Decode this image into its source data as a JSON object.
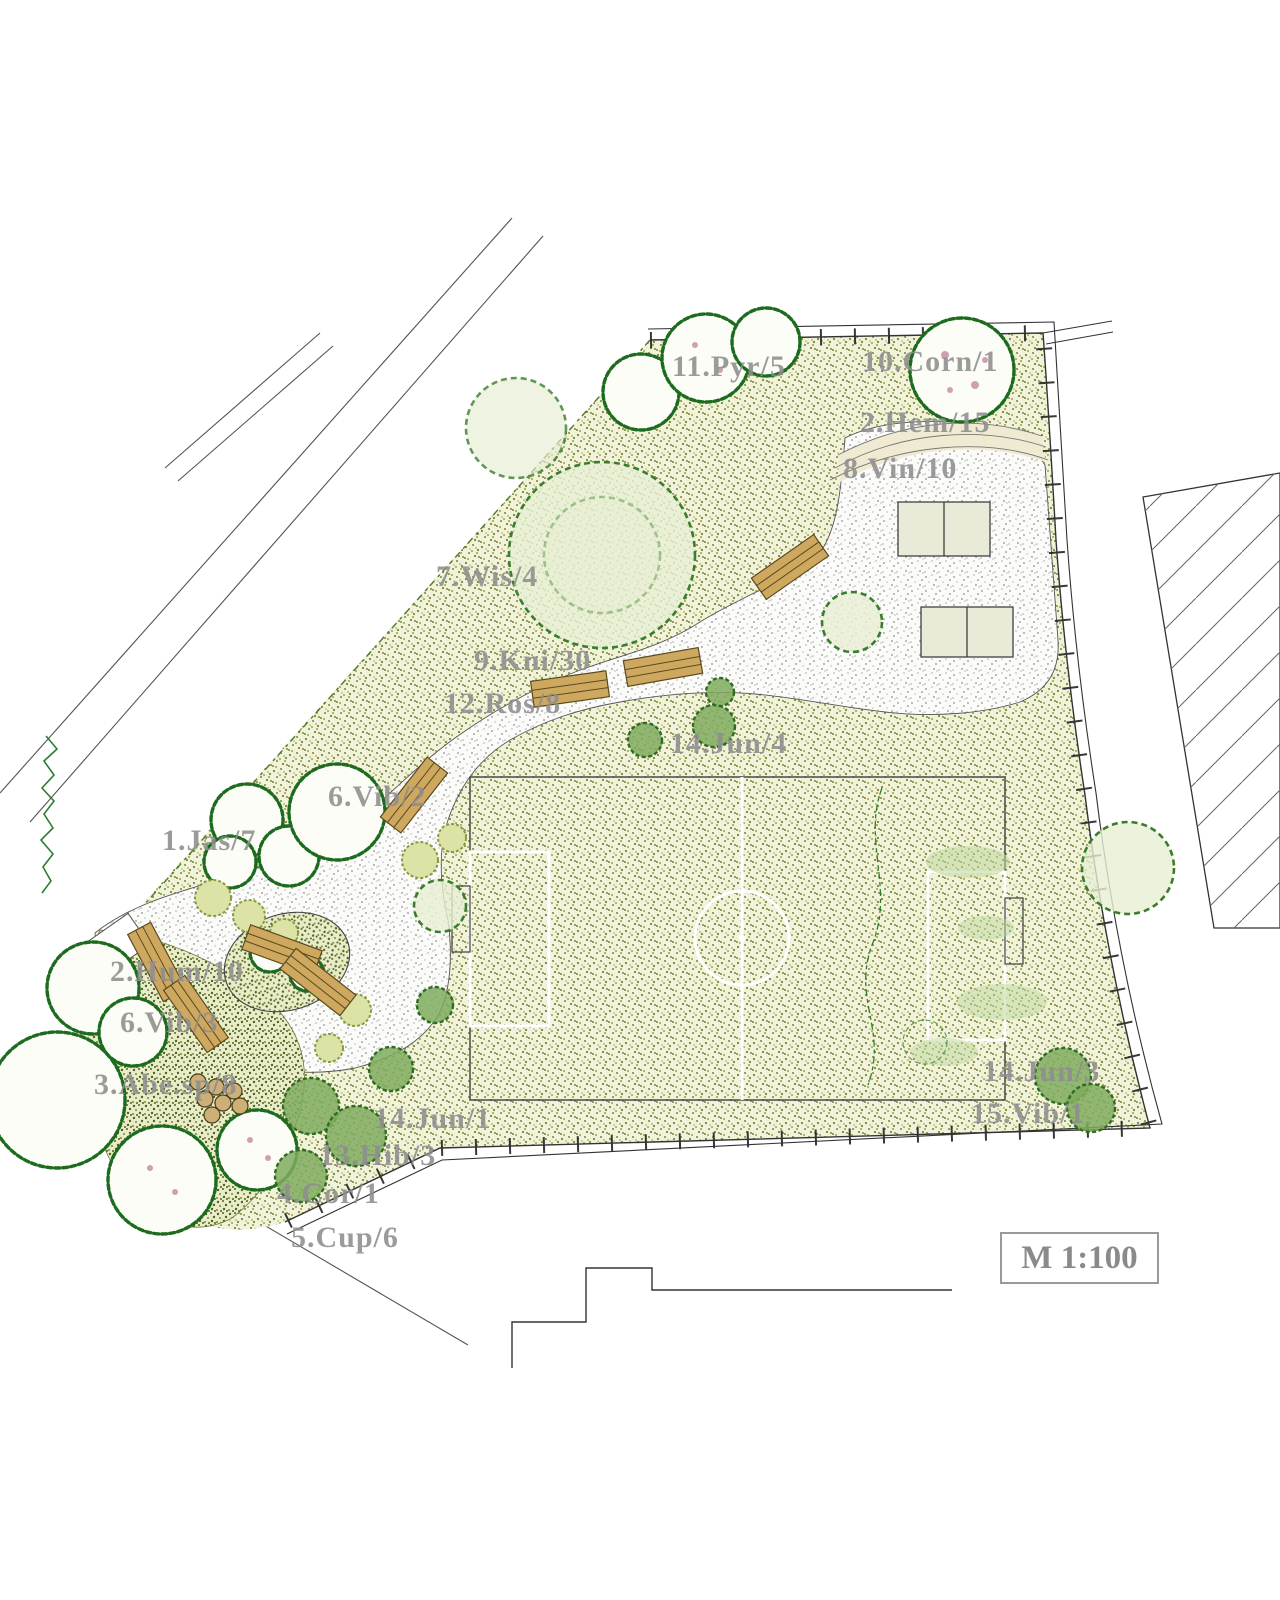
{
  "plan": {
    "scale_label": "M 1:100",
    "labels": [
      {
        "text": "11.Pyr/5"
      },
      {
        "text": "10.Corn/1"
      },
      {
        "text": "2.Hem/15"
      },
      {
        "text": "8.Vin/10"
      },
      {
        "text": "7.Wis/4"
      },
      {
        "text": "9.Kni/30"
      },
      {
        "text": "12.Ros/8"
      },
      {
        "text": "14.Jun/4"
      },
      {
        "text": "6.Vib/2"
      },
      {
        "text": "1.Jas/7"
      },
      {
        "text": "2.Hum/10"
      },
      {
        "text": "6.Vib/3"
      },
      {
        "text": "3.Abe.sp/8"
      },
      {
        "text": "14.Jun/1"
      },
      {
        "text": "13.Hib/3"
      },
      {
        "text": "4.Cor/1"
      },
      {
        "text": "5.Cup/6"
      },
      {
        "text": "14.Jun/3"
      },
      {
        "text": "15.Vib/1"
      }
    ]
  },
  "colors": {
    "grass_bg": "#f1f2da",
    "grass_dot": "#7e8536",
    "bed_bg": "#e9ecc8",
    "bed_dot": "#4f6424",
    "path_bg": "#fbfbfa",
    "path_dot": "#a9a9a9",
    "bench_wood": "#cfa85f",
    "table_fill": "#e9ead8",
    "field_line": "#ffffff",
    "outline": "#444444",
    "tree_green": "#1d6b1f",
    "canopy_green": "#3a7d2c",
    "label_gray": "#8e8e8e"
  }
}
